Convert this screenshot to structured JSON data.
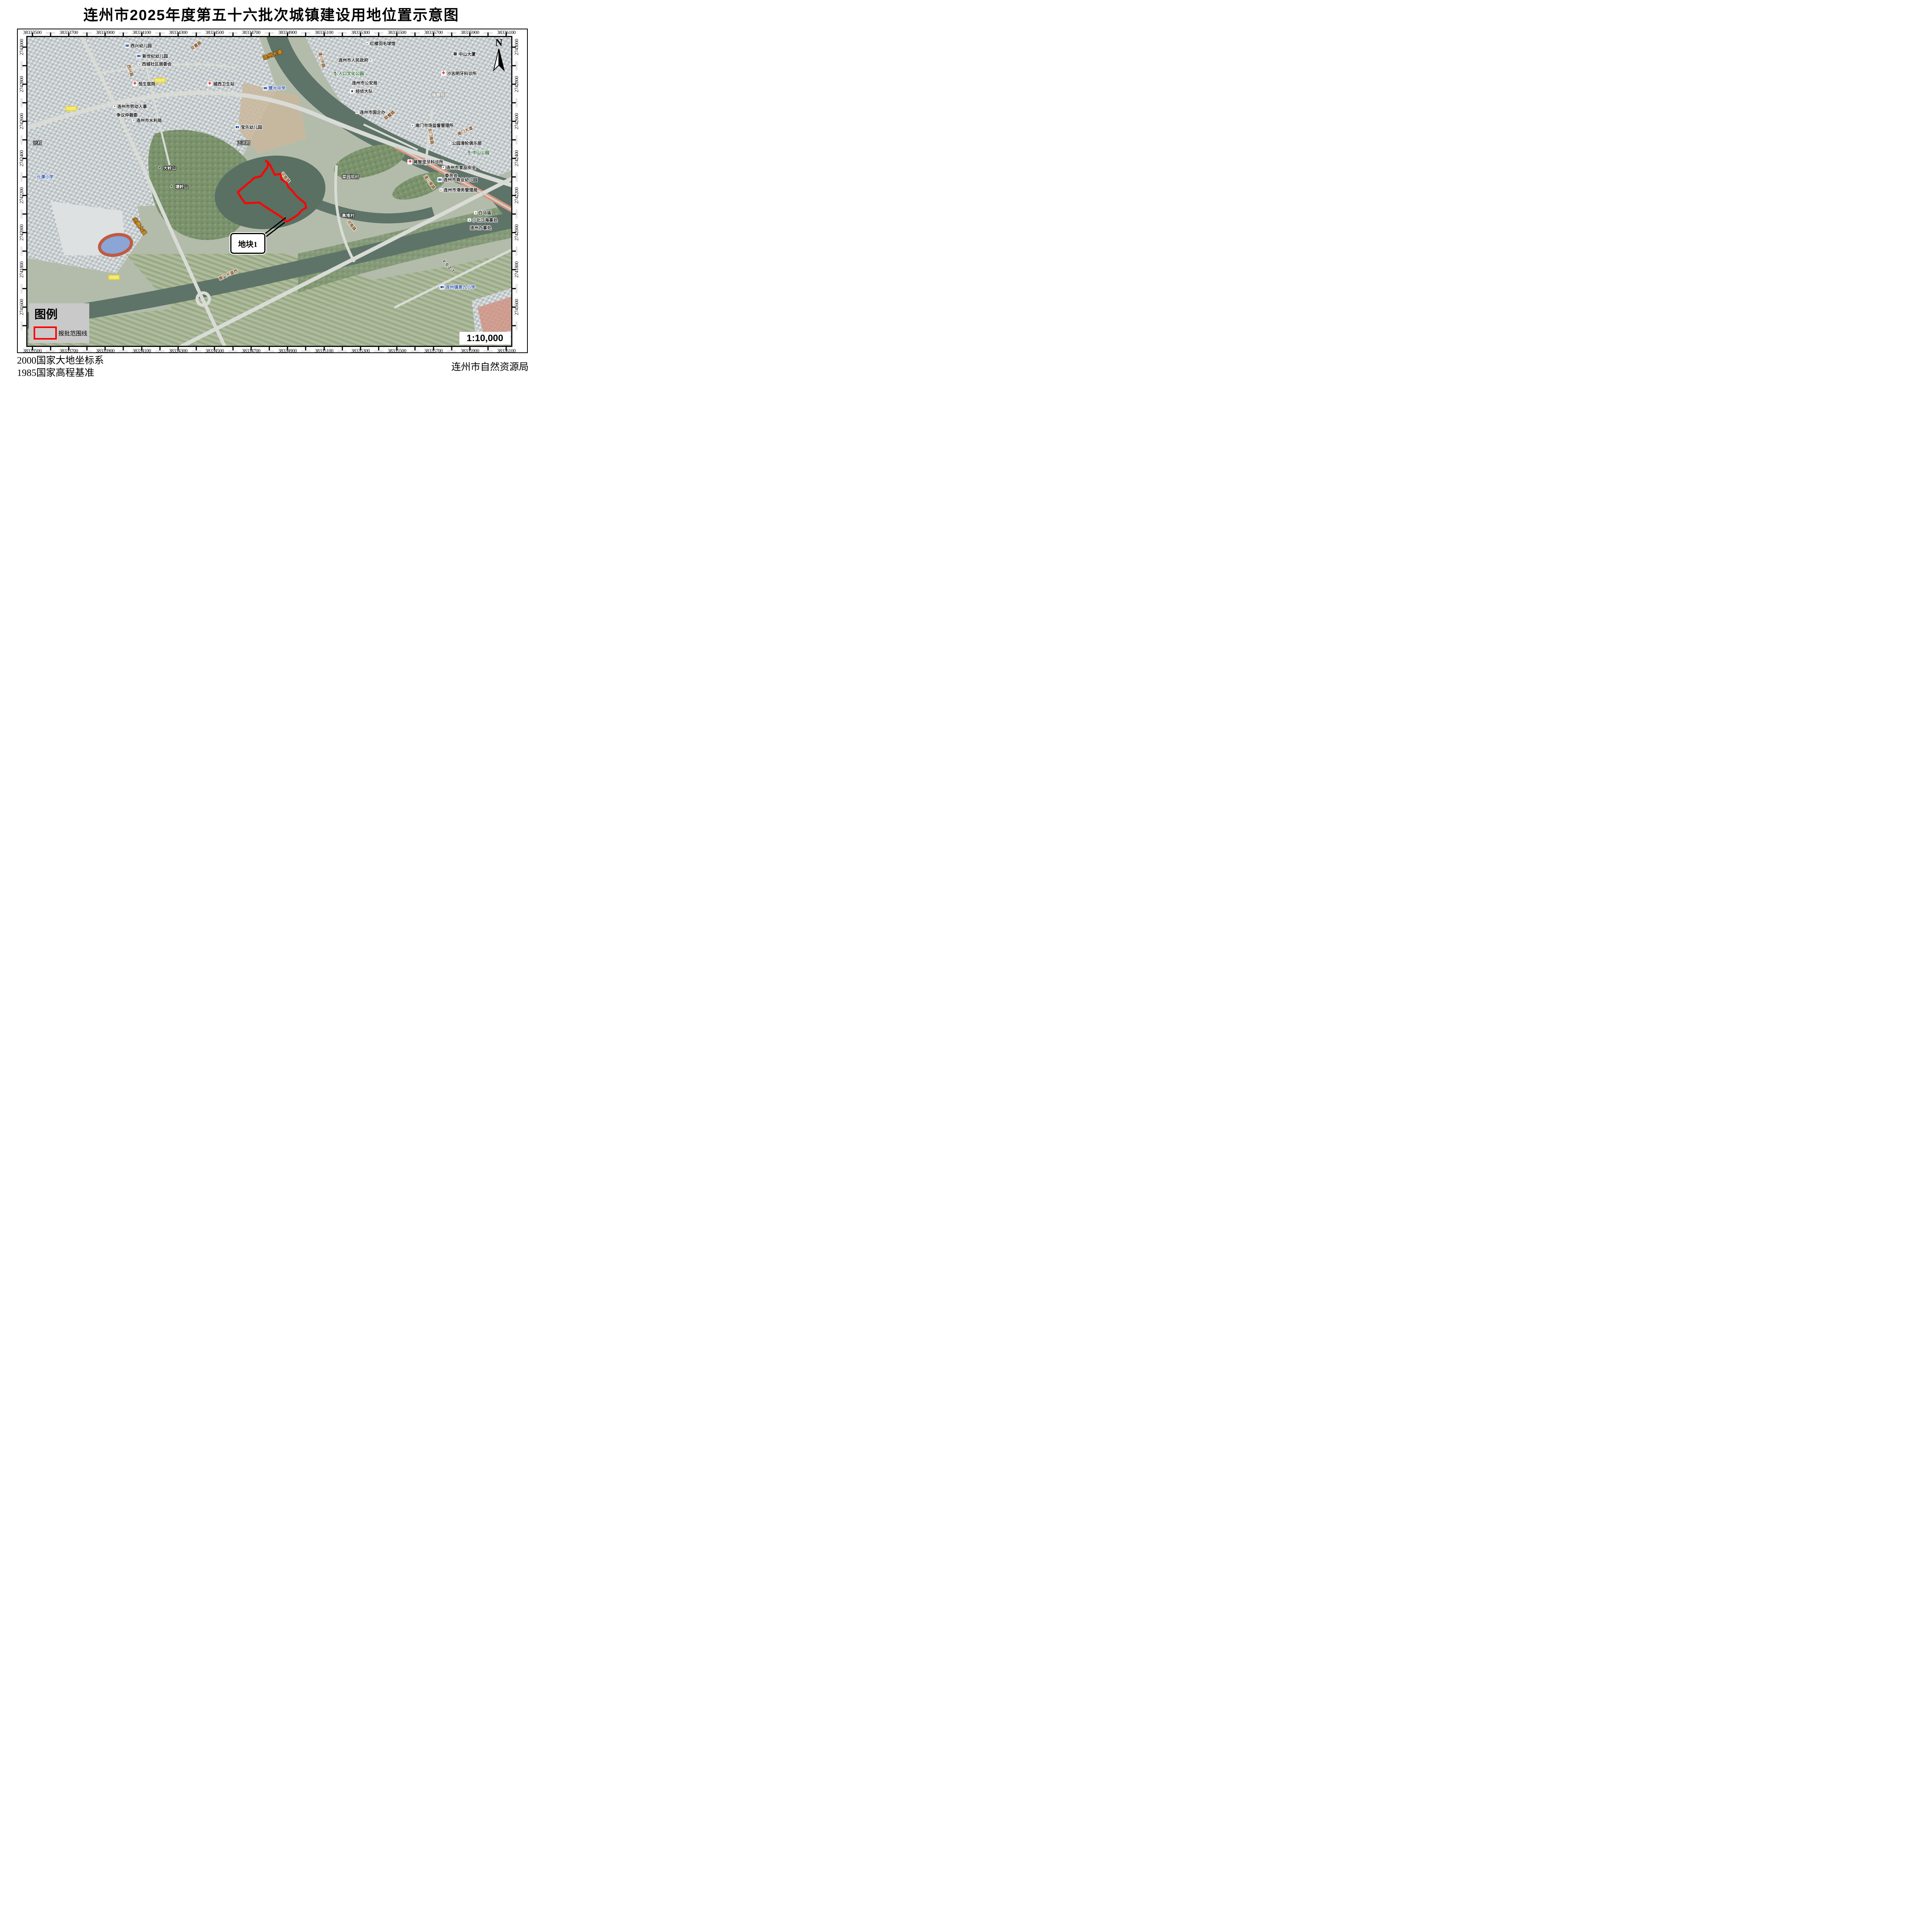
{
  "title": "连州市2025年度第五十六批次城镇建设用地位置示意图",
  "north_label": "N",
  "scale_text": "1:10,000",
  "footer": {
    "left_line1": "2000国家大地坐标系",
    "left_line2": "1985国家高程基准",
    "right": "连州市自然资源局"
  },
  "legend": {
    "title": "图例",
    "items": [
      {
        "label": "报批范围线",
        "color": "#ff0000"
      }
    ]
  },
  "grid": {
    "top_labels": [
      "38333500",
      "38333700",
      "38333900",
      "38334100",
      "38334300",
      "38334500",
      "38334700",
      "38334900",
      "38335100",
      "38335300",
      "38335500",
      "38335700",
      "38335900",
      "38336100"
    ],
    "side_labels": [
      "2743000",
      "2742800",
      "2742600",
      "2742400",
      "2742200",
      "2742000",
      "2741800",
      "2741600"
    ],
    "minor_label": "000000",
    "top_first": 1.0,
    "top_step": 7.538,
    "side_first": 3.6,
    "side_step": 12.03
  },
  "parcel": {
    "label": "地块1",
    "boundary_color": "#ff0000",
    "polygon": [
      [
        49.3,
        40.1
      ],
      [
        49.8,
        40.6
      ],
      [
        49.6,
        42.2
      ],
      [
        49.1,
        43.2
      ],
      [
        48.3,
        45.0
      ],
      [
        47.5,
        45.4
      ],
      [
        47.0,
        45.5
      ],
      [
        45.9,
        47.0
      ],
      [
        44.6,
        48.7
      ],
      [
        43.5,
        50.2
      ],
      [
        44.1,
        51.9
      ],
      [
        45.0,
        53.8
      ],
      [
        46.4,
        53.7
      ],
      [
        47.9,
        53.6
      ],
      [
        50.1,
        55.9
      ],
      [
        52.4,
        58.2
      ],
      [
        53.2,
        59.3
      ],
      [
        53.6,
        59.8
      ],
      [
        54.6,
        58.9
      ],
      [
        55.8,
        57.7
      ],
      [
        56.8,
        56.0
      ],
      [
        57.6,
        55.3
      ],
      [
        57.4,
        53.8
      ],
      [
        56.5,
        52.7
      ],
      [
        55.5,
        51.3
      ],
      [
        54.9,
        50.1
      ],
      [
        53.9,
        48.5
      ],
      [
        53.6,
        47.2
      ],
      [
        52.5,
        46.1
      ],
      [
        52.3,
        44.3
      ],
      [
        51.1,
        44.6
      ],
      [
        50.7,
        43.2
      ],
      [
        50.1,
        41.3
      ]
    ],
    "leaders": [
      [
        48.7,
        64.2,
        53.4,
        58.5
      ],
      [
        48.7,
        65.4,
        53.2,
        60.0
      ]
    ],
    "label_box": {
      "x": 41.9,
      "y": 63.5,
      "w": 6.8,
      "h": 6.0
    }
  },
  "map": {
    "labels": [
      {
        "t": "西兴幼儿园",
        "x": 22.9,
        "y": 2.9,
        "type": "poi",
        "icon": "book"
      },
      {
        "t": "新世纪幼儿园",
        "x": 25.8,
        "y": 6.2,
        "type": "poi",
        "icon": "book"
      },
      {
        "t": "双喜路",
        "x": 34.9,
        "y": 2.9,
        "type": "road",
        "rot": -35
      },
      {
        "t": "西城社区居委会",
        "x": 26.3,
        "y": 8.9,
        "type": "poi",
        "icon": "dot"
      },
      {
        "t": "西兴路",
        "x": 21.2,
        "y": 10.9,
        "type": "road",
        "rot": 72
      },
      {
        "t": "恒生医院",
        "x": 24.1,
        "y": 15.3,
        "type": "poi",
        "icon": "cross"
      },
      {
        "t": "G323",
        "x": 27.4,
        "y": 14.0,
        "type": "badge"
      },
      {
        "t": "G323",
        "x": 9.0,
        "y": 23.2,
        "type": "badge"
      },
      {
        "t": "G323",
        "x": 17.9,
        "y": 77.8,
        "type": "badge"
      },
      {
        "t": "连州大道",
        "x": 50.7,
        "y": 5.7,
        "type": "highway",
        "rot": -20
      },
      {
        "t": "城西卫生站",
        "x": 40.0,
        "y": 15.3,
        "type": "poi",
        "icon": "cross"
      },
      {
        "t": "慧光中学",
        "x": 51.0,
        "y": 16.6,
        "type": "school",
        "icon": "book"
      },
      {
        "t": "连州市劳动人事",
        "x": 21.2,
        "y": 22.6,
        "type": "poi",
        "icon": "dot"
      },
      {
        "t": "争议仲裁委",
        "x": 20.6,
        "y": 25.4,
        "type": "poi"
      },
      {
        "t": "连州市水利局",
        "x": 24.7,
        "y": 27.1,
        "type": "poi",
        "icon": "dot"
      },
      {
        "t": "湟川中路",
        "x": 60.8,
        "y": 7.4,
        "type": "road",
        "rot": 75
      },
      {
        "t": "红楼羽毛球馆",
        "x": 73.0,
        "y": 2.3,
        "type": "poi",
        "icon": "dot"
      },
      {
        "t": "连州市人民政府",
        "x": 67.8,
        "y": 7.6,
        "type": "poi",
        "icon": "dot",
        "iconSide": "right"
      },
      {
        "t": "人口文化公园",
        "x": 66.4,
        "y": 11.9,
        "type": "park",
        "icon": "tree"
      },
      {
        "t": "连州市公安局",
        "x": 69.7,
        "y": 15.0,
        "type": "poi"
      },
      {
        "t": "经侦大队",
        "x": 69.0,
        "y": 17.6,
        "type": "poi",
        "icon": "star"
      },
      {
        "t": "中山大厦",
        "x": 90.3,
        "y": 5.6,
        "type": "poi",
        "icon": "bldg"
      },
      {
        "t": "沙志明牙科诊所",
        "x": 89.2,
        "y": 11.9,
        "type": "poi",
        "icon": "cross"
      },
      {
        "t": "建康苑",
        "x": 84.9,
        "y": 18.9,
        "type": "area"
      },
      {
        "t": "连州市国企办",
        "x": 70.9,
        "y": 24.5,
        "type": "poi",
        "icon": "dot"
      },
      {
        "t": "联璧路",
        "x": 74.9,
        "y": 25.4,
        "type": "road",
        "rot": -38
      },
      {
        "t": "南门市场监督管理所",
        "x": 83.7,
        "y": 28.8,
        "type": "poi",
        "icon": "dot"
      },
      {
        "t": "东门南路",
        "x": 83.3,
        "y": 32.2,
        "type": "road",
        "rot": 80
      },
      {
        "t": "南门大道",
        "x": 90.5,
        "y": 30.5,
        "type": "road",
        "rot": -25
      },
      {
        "t": "公园滑轮俱乐部",
        "x": 90.4,
        "y": 34.5,
        "type": "poi",
        "icon": "dot"
      },
      {
        "t": "中山公园",
        "x": 93.2,
        "y": 37.5,
        "type": "park",
        "icon": "tree"
      },
      {
        "t": "蒋智坚牙科诊所",
        "x": 82.3,
        "y": 40.5,
        "type": "poi",
        "icon": "cross"
      },
      {
        "t": "连州市食品安全",
        "x": 89.2,
        "y": 42.4,
        "type": "poi",
        "icon": "dot"
      },
      {
        "t": "委员会",
        "x": 87.6,
        "y": 45.0,
        "type": "poi"
      },
      {
        "t": "连州市商业幼儿园",
        "x": 88.9,
        "y": 46.3,
        "type": "poi",
        "icon": "book"
      },
      {
        "t": "湟川南路",
        "x": 83.1,
        "y": 47.1,
        "type": "road",
        "rot": 55
      },
      {
        "t": "连州市港务管理局",
        "x": 89.1,
        "y": 49.7,
        "type": "poi",
        "icon": "dot"
      },
      {
        "t": "白马庙",
        "x": 94.1,
        "y": 57.1,
        "type": "poi",
        "icon": "dot"
      },
      {
        "t": "小北江海事处",
        "x": 94.1,
        "y": 59.5,
        "type": "poi",
        "icon": "dot"
      },
      {
        "t": "连州办事处",
        "x": 93.7,
        "y": 62.0,
        "type": "poi"
      },
      {
        "t": "元村",
        "x": 1.2,
        "y": 34.4,
        "type": "village",
        "anchor": "left"
      },
      {
        "t": "元潭小学",
        "x": 1.9,
        "y": 45.4,
        "type": "school",
        "anchor": "left"
      },
      {
        "t": "大岭山",
        "x": 28.8,
        "y": 42.5,
        "type": "village",
        "icon": "mtn"
      },
      {
        "t": "塘岭山",
        "x": 31.3,
        "y": 48.5,
        "type": "village",
        "icon": "mtn"
      },
      {
        "t": "宝乐幼儿园",
        "x": 45.7,
        "y": 29.3,
        "type": "poi",
        "icon": "book"
      },
      {
        "t": "正河村",
        "x": 44.7,
        "y": 34.4,
        "type": "village"
      },
      {
        "t": "河南路",
        "x": 53.3,
        "y": 45.6,
        "type": "road",
        "rot": 52
      },
      {
        "t": "菜园坝村",
        "x": 66.8,
        "y": 45.4,
        "type": "village"
      },
      {
        "t": "高堆村",
        "x": 66.3,
        "y": 58.0,
        "type": "village"
      },
      {
        "t": "河南路",
        "x": 66.9,
        "y": 61.1,
        "type": "road",
        "rot": 52
      },
      {
        "t": "Y027",
        "x": 87.1,
        "y": 74.5,
        "type": "roadcode",
        "rot": 48
      },
      {
        "t": "连州镇第九小学",
        "x": 88.9,
        "y": 81.1,
        "type": "school",
        "icon": "book"
      },
      {
        "t": "南门大道西",
        "x": 41.5,
        "y": 77.1,
        "type": "road",
        "rot": -25
      },
      {
        "t": "龙腾大道",
        "x": 23.2,
        "y": 61.3,
        "type": "highway",
        "rot": 55
      }
    ]
  },
  "colors": {
    "boundary": "#ff0000",
    "legend_bg": "#c9c9c9",
    "road_label": "#7a4a17",
    "highway_label": "#e8a22e",
    "school_label": "#3f62b5",
    "park_label": "#2e6930",
    "badge_bg": "#f2e440",
    "water": "#5e7468",
    "embankment": "#db9580"
  }
}
